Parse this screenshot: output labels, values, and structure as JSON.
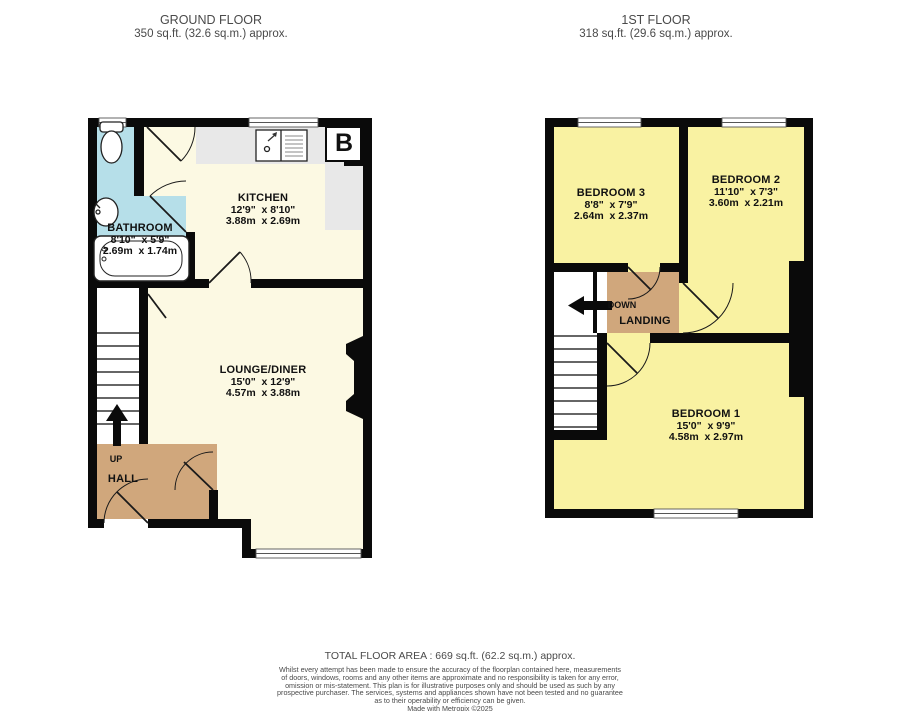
{
  "plans": {
    "ground": {
      "title": "GROUND FLOOR",
      "area": "350 sq.ft. (32.6 sq.m.) approx.",
      "rooms": {
        "kitchen": {
          "name": "KITCHEN",
          "imperial": "12'9\"  x 8'10\"",
          "metric": "3.88m  x 2.69m"
        },
        "bathroom": {
          "name": "BATHROOM",
          "imperial": "8'10\"  x 5'9\"",
          "metric": "2.69m  x 1.74m"
        },
        "lounge": {
          "name": "LOUNGE/DINER",
          "imperial": "15'0\"  x 12'9\"",
          "metric": "4.57m  x 3.88m"
        },
        "hall": {
          "name": "HALL"
        }
      },
      "labels": {
        "up": "UP",
        "boiler": "B"
      }
    },
    "first": {
      "title": "1ST FLOOR",
      "area": "318 sq.ft. (29.6 sq.m.) approx.",
      "rooms": {
        "bedroom3": {
          "name": "BEDROOM 3",
          "imperial": "8'8\"  x 7'9\"",
          "metric": "2.64m  x 2.37m"
        },
        "bedroom2": {
          "name": "BEDROOM 2",
          "imperial": "11'10\"  x 7'3\"",
          "metric": "3.60m  x 2.21m"
        },
        "bedroom1": {
          "name": "BEDROOM 1",
          "imperial": "15'0\"  x 9'9\"",
          "metric": "4.58m  x 2.97m"
        },
        "landing": {
          "name": "LANDING"
        }
      },
      "labels": {
        "down": "DOWN"
      }
    }
  },
  "footer": {
    "total": "TOTAL FLOOR AREA : 669 sq.ft. (62.2 sq.m.) approx.",
    "disclaimer": [
      "Whilst every attempt has been made to ensure the accuracy of the floorplan contained here, measurements",
      "of doors, windows, rooms and any other items are approximate and no responsibility is taken for any error,",
      "omission or mis-statement. This plan is for illustrative purposes only and should be used as such by any",
      "prospective purchaser. The services, systems and appliances shown have not been tested and no guarantee",
      "as to their operability or efficiency can be given."
    ],
    "credit": "Made with Metropix ©2025"
  },
  "colors": {
    "wall": "#0a0a0a",
    "room_cream": "#fcf9e3",
    "room_yellow": "#f9f2a2",
    "bathroom_cyan": "#b6dfe9",
    "hall_tan": "#d0a77c",
    "counter_grey": "#e8e8e8"
  }
}
